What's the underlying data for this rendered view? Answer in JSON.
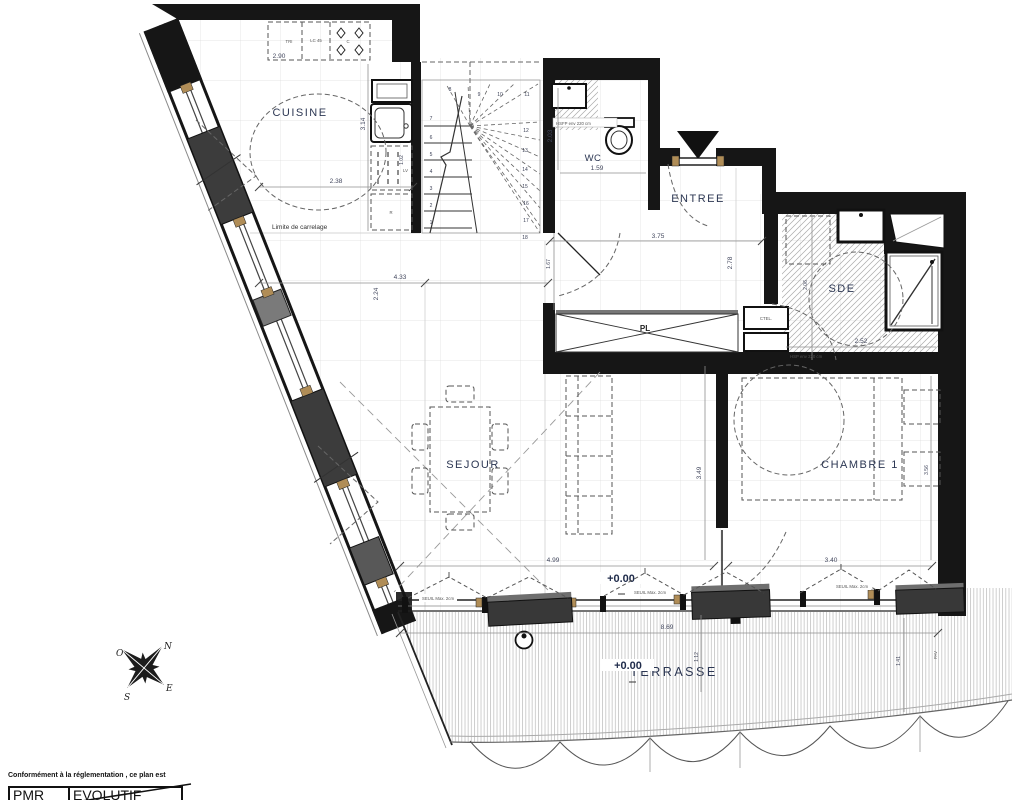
{
  "rooms": {
    "cuisine": "CUISINE",
    "wc": "WC",
    "entree": "ENTREE",
    "sde": "SDE",
    "sejour": "SEJOUR",
    "chambre1": "CHAMBRE 1",
    "terrasse": "TERRASSE",
    "placard": "PL",
    "ctel": "CTEL."
  },
  "appliances": {
    "tri": "TRI",
    "lc45": "LC 45",
    "cooktop": "C",
    "dishwasher": "LV",
    "fridge": "R"
  },
  "levels": {
    "sejour": "+0.00",
    "terrasse": "+0.00"
  },
  "dimensions": {
    "kitchen_counter": "2.90",
    "kitchen_depth": "3.14",
    "kitchen_width": "2.38",
    "kitchen_column": "1.02",
    "sejour_width": "4.33",
    "sejour_depth": "2.24",
    "sejour_length": "4.99",
    "entree_width": "3.75",
    "entree_depth": "2.78",
    "hall_depth": "1.67",
    "wc_depth": "2.03",
    "wc_width": "1.59",
    "sde_width": "2.52",
    "sde_depth": "2.06",
    "chambre_left": "3.49",
    "chambre_width": "3.40",
    "chambre_right": "3.56",
    "terrasse_width": "8.69",
    "terrasse_left": "1.12",
    "terrasse_right": "1.41",
    "paving": "PAV"
  },
  "annotations": {
    "limite_carrelage": "Limite de carrelage",
    "seuil_1": "SEUIL Max. 2cm",
    "seuil_2": "SEUIL Max. 2cm",
    "seuil_3": "SEUIL Max. 2cm",
    "hsfp_wc": "HSFP env 220 cm",
    "hsp_sde": "HSP env 220 cm"
  },
  "stairs": {
    "steps": [
      "1",
      "2",
      "3",
      "4",
      "5",
      "6",
      "7",
      "8",
      "9",
      "10",
      "11",
      "12",
      "13",
      "14",
      "15",
      "16",
      "17",
      "18"
    ]
  },
  "compass": {
    "north": "N",
    "east": "E",
    "south": "S",
    "west": "O"
  },
  "footer": {
    "note": "Conformément à la réglementation , ce plan est",
    "pmr": "PMR",
    "evolutif": "EVOLUTIF"
  },
  "colors": {
    "wall": "#161616",
    "shutter": "#3c3c3c",
    "label": "#2c3753",
    "wood": "#b08d57"
  }
}
